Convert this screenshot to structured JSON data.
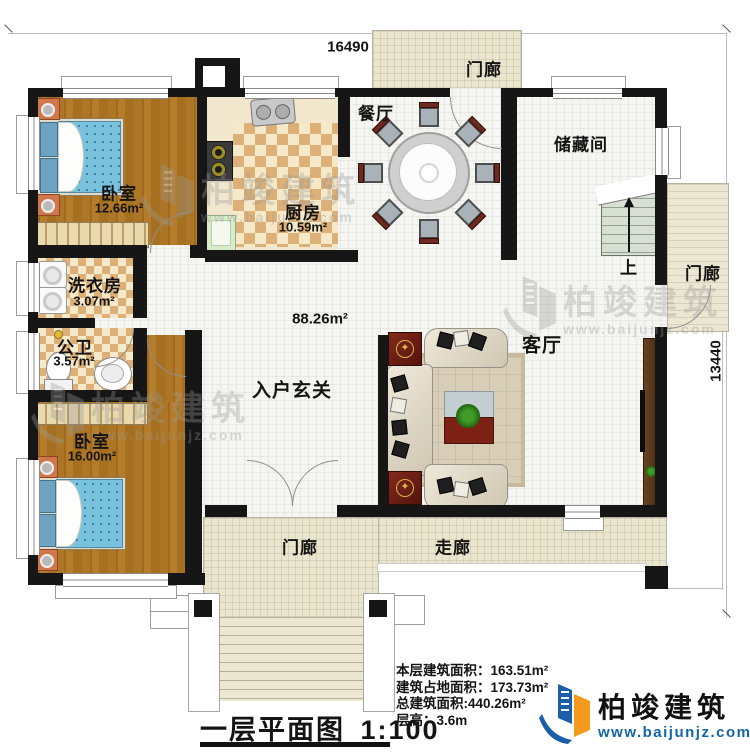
{
  "title": {
    "text": "一层平面图",
    "scale": "1:100"
  },
  "dimensions": {
    "width": "16490",
    "height": "13440"
  },
  "rooms": {
    "bedroom1": {
      "label": "卧室",
      "area": "12.66m²"
    },
    "kitchen": {
      "label": "厨房",
      "area": "10.59m²"
    },
    "dining": {
      "label": "餐厅"
    },
    "storage": {
      "label": "储藏间"
    },
    "stairs": {
      "label": "上"
    },
    "laundry": {
      "label": "洗衣房",
      "area": "3.07m²"
    },
    "bathroom": {
      "label": "公卫",
      "area": "3.57m²"
    },
    "bedroom2": {
      "label": "卧室",
      "area": "16.00m²"
    },
    "foyer": {
      "label": "入户玄关",
      "area": "88.26m²"
    },
    "living": {
      "label": "客厅"
    },
    "porch_top": {
      "label": "门廊"
    },
    "porch_right": {
      "label": "门廊"
    },
    "porch_bottom": {
      "label": "门廊"
    },
    "corridor": {
      "label": "走廊"
    }
  },
  "stats": {
    "rows": [
      {
        "label": "本层建筑面积：",
        "value": "163.51m²"
      },
      {
        "label": "建筑占地面积：",
        "value": "173.73m²"
      },
      {
        "label": "总建筑面积:",
        "value": "440.26m²"
      },
      {
        "label": "层高：",
        "value": "3.6m"
      }
    ]
  },
  "brand": {
    "name": "柏竣建筑",
    "url": "www.baijunjz.com"
  },
  "watermark": {
    "name": "柏竣建筑",
    "url": "www.baijunjz.com"
  },
  "colors": {
    "wall": "#161616",
    "brand_blue": "#1b5fa8",
    "brand_orange": "#f59a1d",
    "url_blue": "#1465a8"
  }
}
